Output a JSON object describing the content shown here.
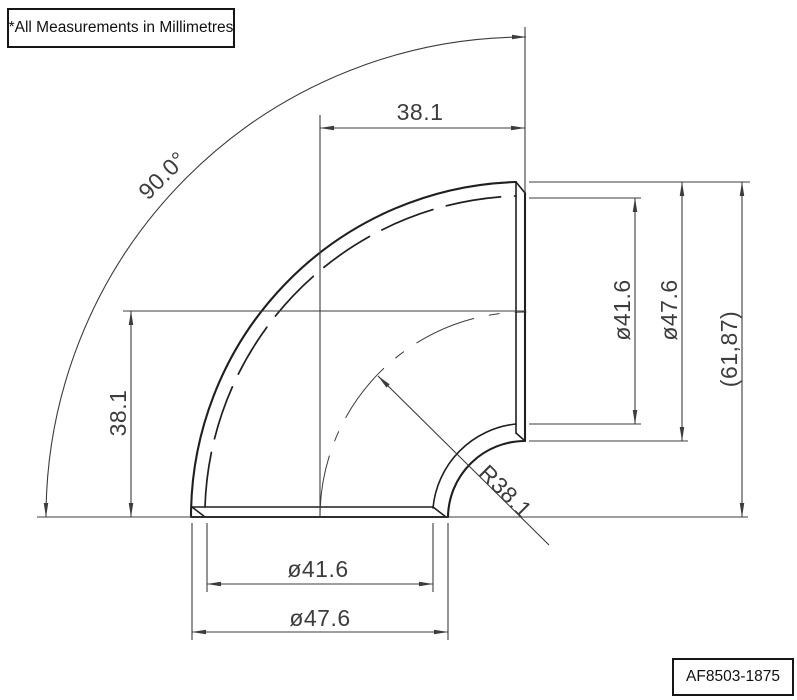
{
  "colors": {
    "background": "#ffffff",
    "outline": "#1f1f1f",
    "dimension": "#3c3c3c"
  },
  "note_box": {
    "text": "*All Measurements in Millimetres"
  },
  "part_box": {
    "text": "AF8503-1875"
  },
  "dimensions": {
    "angle": "90.0°",
    "top_offset": "38.1",
    "left_offset": "38.1",
    "side_inner_diameter": "ø41.6",
    "side_outer_diameter": "ø47.6",
    "overall_height": "(61,87)",
    "bend_radius": "R38.1",
    "bottom_inner_diameter": "ø41.6",
    "bottom_outer_diameter": "ø47.6"
  }
}
